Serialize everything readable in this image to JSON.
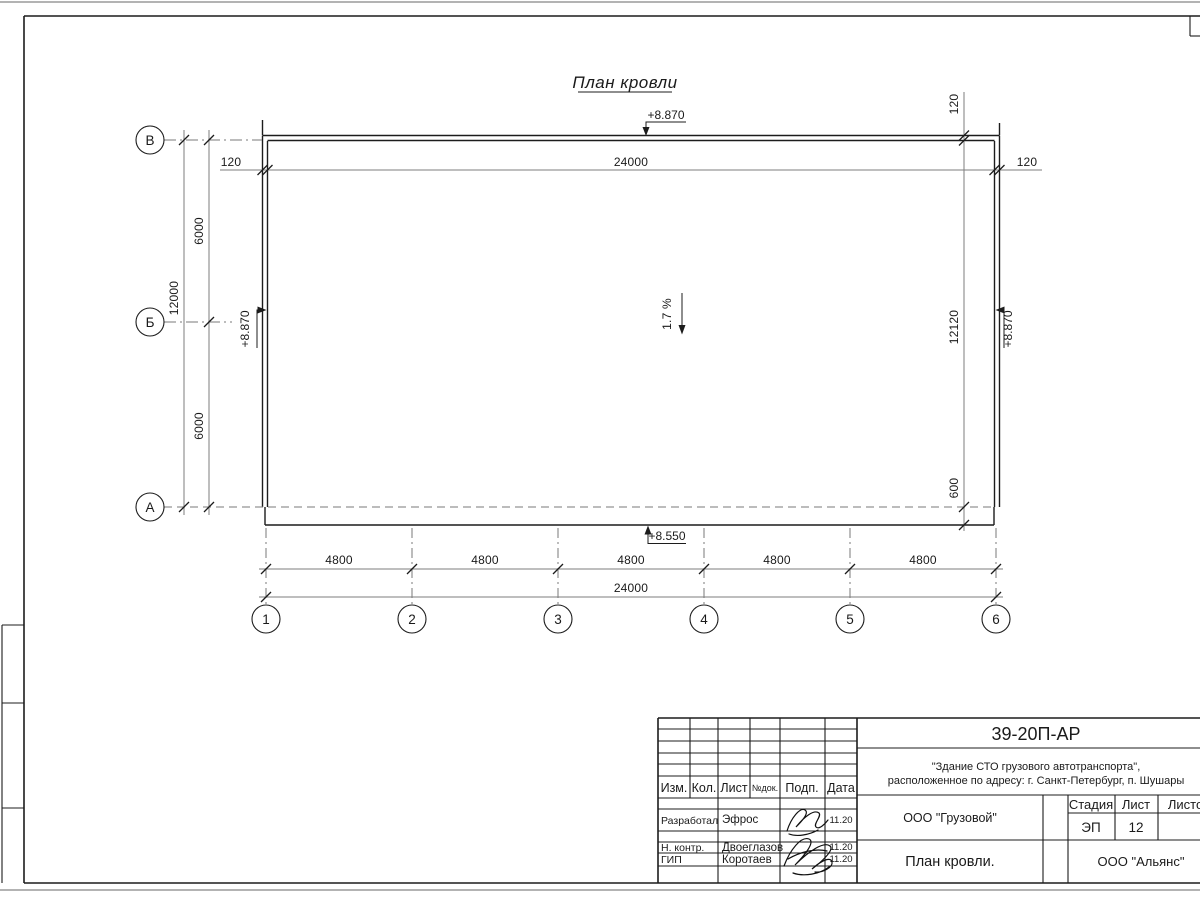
{
  "title": "План кровли",
  "plan": {
    "slope": "1.7 %",
    "elevations": {
      "top": "+8.870",
      "left": "+8.870",
      "right": "+8.870",
      "eave": "+8.550"
    },
    "dims": {
      "top_left_offset": "120",
      "top_total": "24000",
      "top_right_offset": "120",
      "right_parapet_offset": "120",
      "right_total": "12120",
      "right_eave": "600",
      "left_total": "12000",
      "left_span_upper": "6000",
      "left_span_lower": "6000",
      "bottom_spans": [
        "4800",
        "4800",
        "4800",
        "4800",
        "4800"
      ],
      "bottom_total": "24000"
    },
    "axes": {
      "rows": [
        "В",
        "Б",
        "А"
      ],
      "cols": [
        "1",
        "2",
        "3",
        "4",
        "5",
        "6"
      ]
    }
  },
  "titleblock": {
    "doc_number": "39-20П-АР",
    "project_line1": "\"Здание СТО грузового автотранспорта\",",
    "project_line2": "расположенное по адресу: г. Санкт-Петербург, п. Шушары",
    "header": {
      "izm": "Изм.",
      "kol": "Кол.",
      "list": "Лист",
      "ndok": "№док.",
      "podp": "Подп.",
      "data": "Дата"
    },
    "rows": [
      {
        "role": "Разработал",
        "name": "Эфрос",
        "date": "11.20"
      },
      {
        "role": "Н. контр.",
        "name": "Двоеглазов",
        "date": "11.20"
      },
      {
        "role": "ГИП",
        "name": "Коротаев",
        "date": "11.20"
      }
    ],
    "org": "ООО \"Грузовой\"",
    "sheet_title": "План кровли.",
    "company": "ООО \"Альянс\"",
    "stage_label": "Стадия",
    "sheet_label": "Лист",
    "sheets_label": "Листов",
    "stage_value": "ЭП",
    "sheet_number": "12"
  }
}
